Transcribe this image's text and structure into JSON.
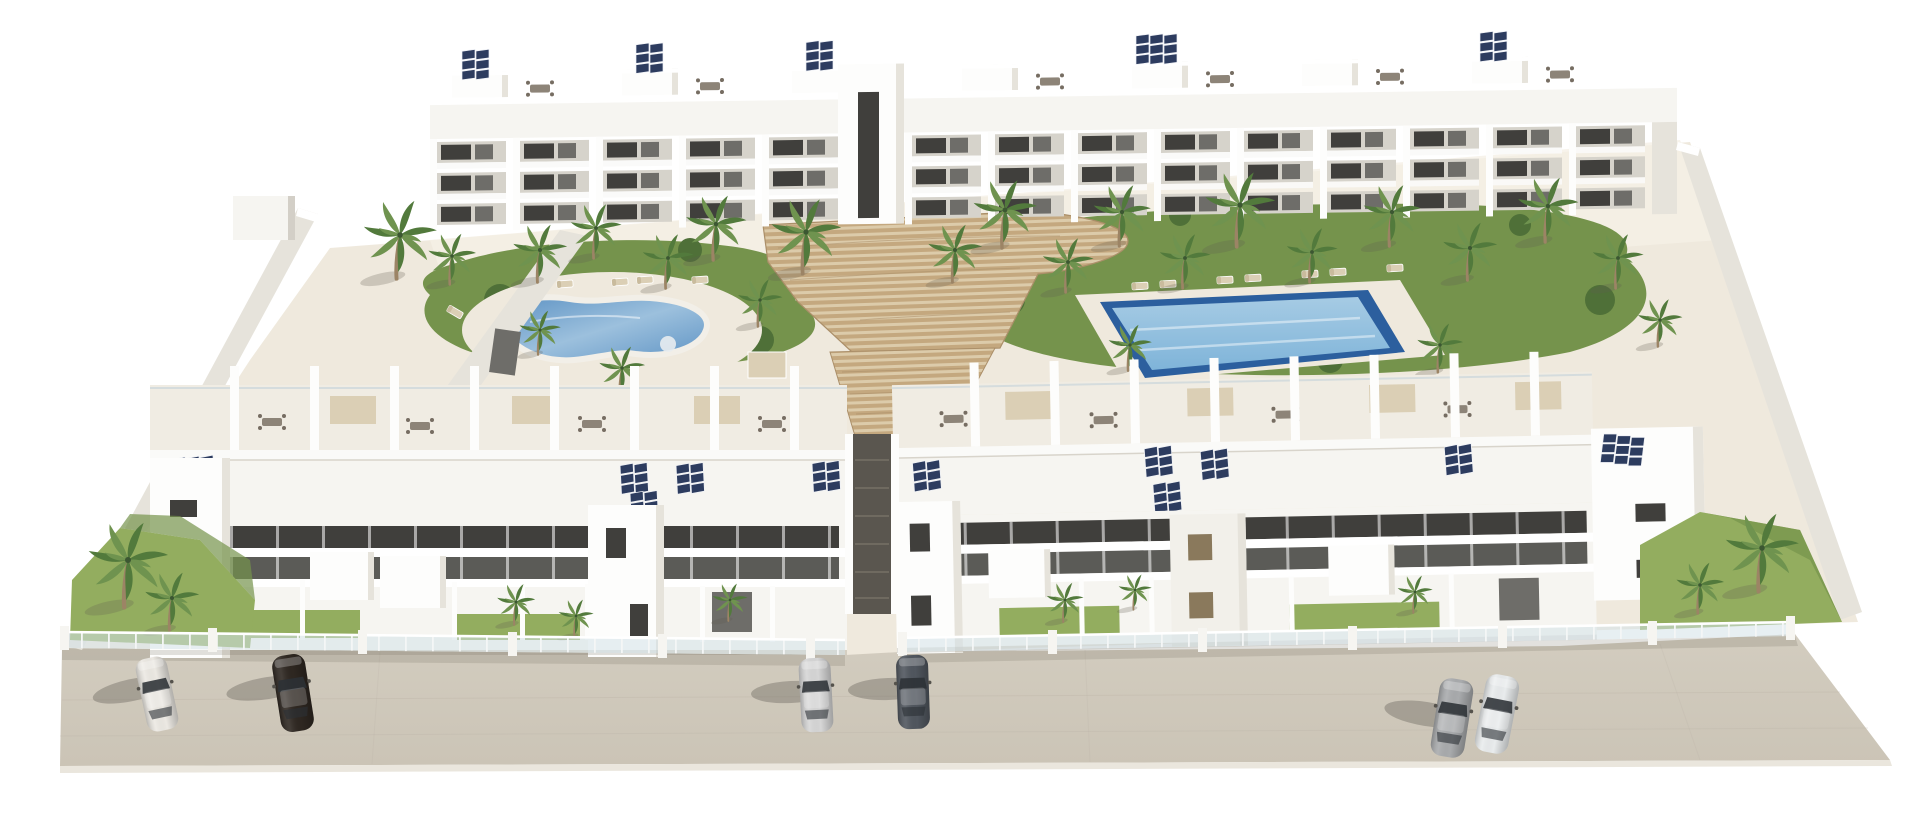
{
  "scene": {
    "title": "Aerial 3D render of a white residential apartment complex",
    "type": "architectural-visualization",
    "view": "aerial three-quarter perspective",
    "background": "plain white",
    "inventory": {
      "buildings": [
        {
          "name": "rear-apartment-block",
          "floors": 3,
          "features": [
            "roof terraces with dining sets",
            "solar panels",
            "recessed balconies"
          ]
        },
        {
          "name": "front-left-block",
          "floors": 3,
          "features": [
            "penthouse terraces",
            "solar panels",
            "walled garden patios",
            "stair towers"
          ]
        },
        {
          "name": "front-right-block",
          "floors": 3,
          "features": [
            "penthouse terraces",
            "solar panels",
            "walled garden patios",
            "corner tower"
          ]
        }
      ],
      "pools": [
        {
          "name": "kidney-pool",
          "shape": "freeform",
          "side": "left"
        },
        {
          "name": "lap-pool",
          "shape": "rectangular",
          "side": "right"
        }
      ],
      "landscape": {
        "palm_trees": 34,
        "lawns": 6,
        "sun_loungers": 13,
        "timber_step_deck": 1,
        "shade_canopies": 2
      },
      "solar_arrays": 15,
      "fencing": "frameless glass balustrade with white piers",
      "cars": [
        {
          "position": "left",
          "color_key": "car_white"
        },
        {
          "position": "left",
          "color_key": "car_black"
        },
        {
          "position": "center",
          "color_key": "car_silver"
        },
        {
          "position": "center",
          "color_key": "car_graphite"
        },
        {
          "position": "right",
          "color_key": "car_gray"
        },
        {
          "position": "right",
          "color_key": "car_pearl"
        }
      ]
    }
  },
  "colors": {
    "bg": "#ffffff",
    "road": "#cbc4b6",
    "road_seam": "#b8b1a3",
    "curb": "#eae6dd",
    "cream": "#efe9dd",
    "cream_light": "#f5f0e6",
    "wall": "#f6f5f1",
    "wall_bright": "#fdfdfc",
    "wall_shade": "#e6e3db",
    "wall_dark": "#d3cfc7",
    "parapet_line": "#d8d4cb",
    "win_dark": "#403f3c",
    "win_mid": "#6e6d69",
    "recess": "#d6d3cb",
    "rail": "#fafaf8",
    "solar": "#2d3c5f",
    "solar_frame": "#eef0f5",
    "grass": "#93ad5f",
    "grass_dark": "#75934c",
    "bush": "#4f7038",
    "palm": "#6f934f",
    "palm_dark": "#527a3c",
    "trunk": "#9c8465",
    "deck": "#c4a87f",
    "deck_gap": "#dccbaa",
    "deck_line": "#ab8f69",
    "pool_rim": "#f2efe8",
    "poolL_light": "#9cc0dd",
    "poolL_deep": "#5e93c4",
    "poolR_border": "#2c5f9e",
    "poolR_light": "#a6cbe4",
    "poolR_deep": "#7fb4d9",
    "glass": "#d3e2e8",
    "canopy": "#dbcfb5",
    "furniture": "#8d8478",
    "shutter": "#8a795c",
    "alley": "#5a564f",
    "tree_shadow": "rgba(95,90,78,0.25)",
    "car_shadow": "rgba(70,66,58,0.30)",
    "base_shadow": "rgba(110,104,92,0.20)",
    "car_white": "#ece9e3",
    "car_black": "#2e2721",
    "car_silver": "#d6d6d6",
    "car_graphite": "#50565e",
    "car_gray": "#a9abad",
    "car_pearl": "#e9eced"
  }
}
